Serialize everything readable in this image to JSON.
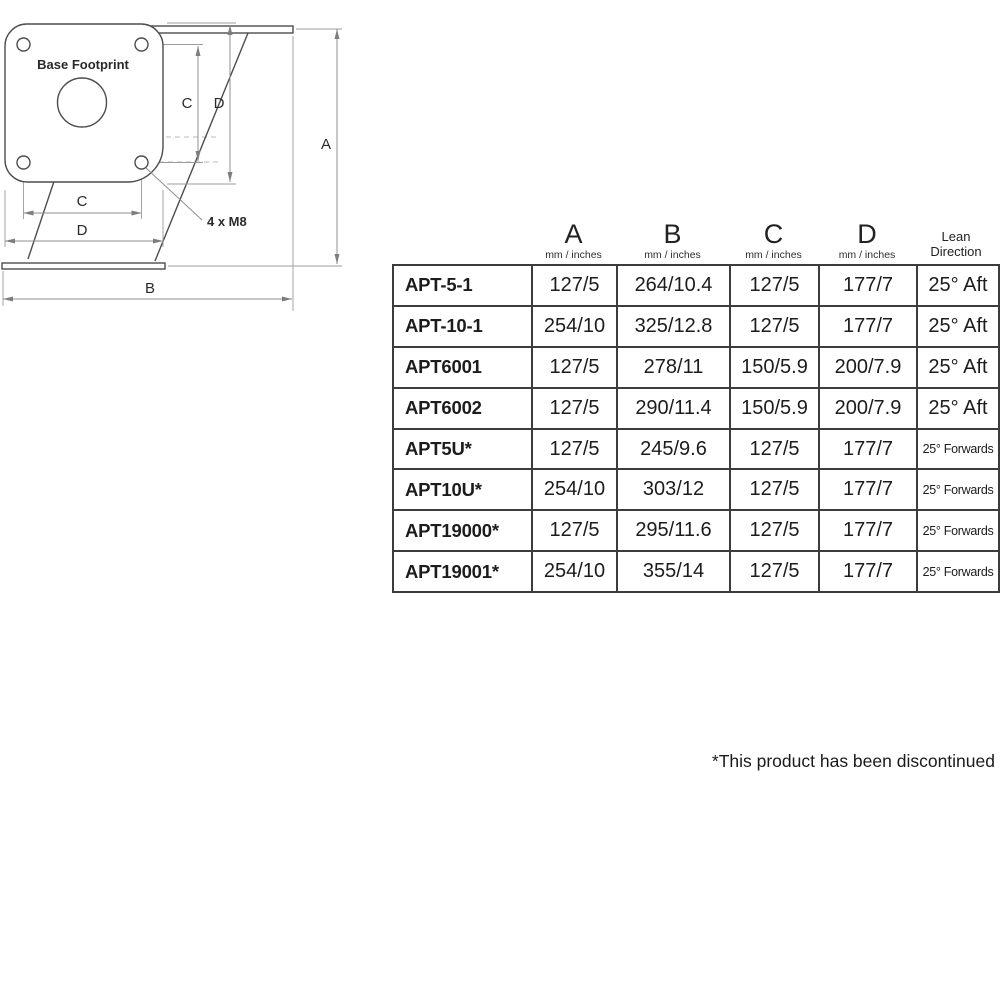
{
  "table": {
    "columns": [
      {
        "letter": "A",
        "unit": "mm / inches"
      },
      {
        "letter": "B",
        "unit": "mm / inches"
      },
      {
        "letter": "C",
        "unit": "mm / inches"
      },
      {
        "letter": "D",
        "unit": "mm / inches"
      }
    ],
    "lean_header": {
      "line1": "Lean",
      "line2": "Direction"
    },
    "rows": [
      {
        "model": "APT-5-1",
        "a": "127/5",
        "b": "264/10.4",
        "c": "127/5",
        "d": "177/7",
        "lean": "25° Aft"
      },
      {
        "model": "APT-10-1",
        "a": "254/10",
        "b": "325/12.8",
        "c": "127/5",
        "d": "177/7",
        "lean": "25° Aft"
      },
      {
        "model": "APT6001",
        "a": "127/5",
        "b": "278/11",
        "c": "150/5.9",
        "d": "200/7.9",
        "lean": "25° Aft"
      },
      {
        "model": "APT6002",
        "a": "127/5",
        "b": "290/11.4",
        "c": "150/5.9",
        "d": "200/7.9",
        "lean": "25° Aft"
      },
      {
        "model": "APT5U*",
        "a": "127/5",
        "b": "245/9.6",
        "c": "127/5",
        "d": "177/7",
        "lean": "25° Forwards"
      },
      {
        "model": "APT10U*",
        "a": "254/10",
        "b": "303/12",
        "c": "127/5",
        "d": "177/7",
        "lean": "25° Forwards"
      },
      {
        "model": "APT19000*",
        "a": "127/5",
        "b": "295/11.6",
        "c": "127/5",
        "d": "177/7",
        "lean": "25° Forwards"
      },
      {
        "model": "APT19001*",
        "a": "254/10",
        "b": "355/14",
        "c": "127/5",
        "d": "177/7",
        "lean": "25° Forwards"
      }
    ]
  },
  "diagram": {
    "side_view": {
      "dim_a": "A",
      "dim_b": "B"
    },
    "footprint": {
      "title": "Base Footprint",
      "dim_c_right": "C",
      "dim_d_right": "D",
      "dim_c_bottom": "C",
      "dim_d_bottom": "D",
      "bolt_note": "4 x M8"
    }
  },
  "footnote": "*This product has been discontinued"
}
